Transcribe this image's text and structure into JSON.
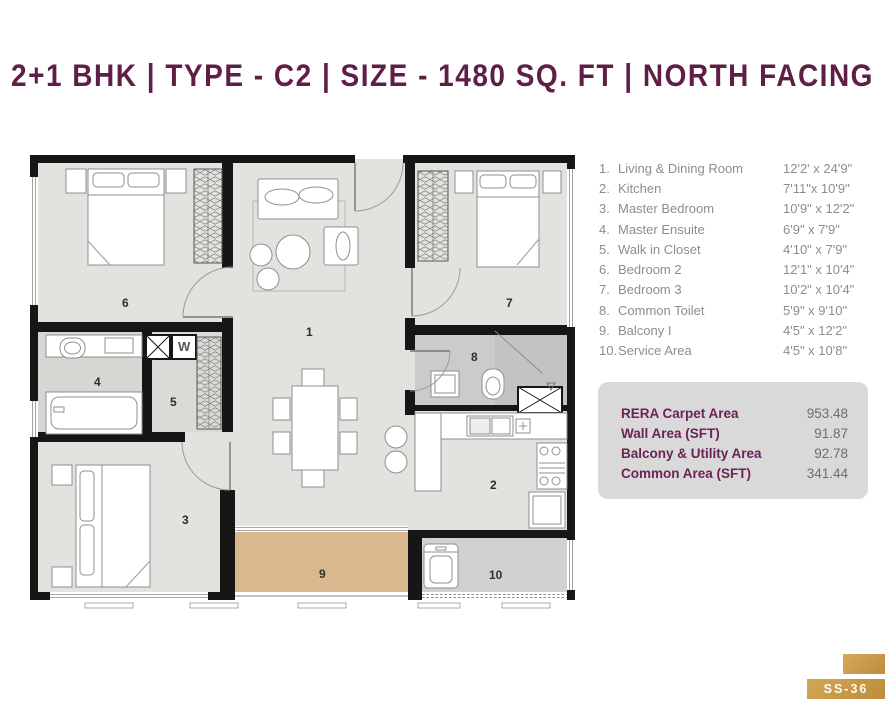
{
  "title": "2+1 BHK | TYPE - C2 | SIZE - 1480 SQ. FT | NORTH  FACING",
  "legend": {
    "items": [
      {
        "num": "1.",
        "label": "Living & Dining Room",
        "dim": "12'2' x 24'9\""
      },
      {
        "num": "2.",
        "label": "Kitchen",
        "dim": "7'11\"x 10'9\""
      },
      {
        "num": "3.",
        "label": "Master Bedroom",
        "dim": "10'9\" x 12'2\""
      },
      {
        "num": "4.",
        "label": "Master Ensuite",
        "dim": "6'9\" x 7'9\""
      },
      {
        "num": "5.",
        "label": "Walk in Closet",
        "dim": "4'10\" x 7'9\""
      },
      {
        "num": "6.",
        "label": "Bedroom 2",
        "dim": "12'1\" x 10'4\""
      },
      {
        "num": "7.",
        "label": "Bedroom 3",
        "dim": "10'2\" x 10'4\""
      },
      {
        "num": "8.",
        "label": "Common Toilet",
        "dim": "5'9\" x 9'10\""
      },
      {
        "num": "9.",
        "label": "Balcony I",
        "dim": "4'5\" x 12'2\""
      },
      {
        "num": "10.",
        "label": "Service Area",
        "dim": "4'5\" x 10'8\""
      }
    ]
  },
  "summary": {
    "rows": [
      {
        "label": "RERA Carpet Area",
        "value": "953.48"
      },
      {
        "label": "Wall Area (SFT)",
        "value": "91.87"
      },
      {
        "label": "Balcony & Utility Area",
        "value": "92.78"
      },
      {
        "label": "Common Area (SFT)",
        "value": "341.44"
      }
    ]
  },
  "plan": {
    "room_numbers": [
      "6",
      "1",
      "7",
      "4",
      "5",
      "8",
      "2",
      "3",
      "9",
      "10"
    ],
    "shaft_w_label": "W"
  },
  "badge": {
    "text": "SS-36"
  },
  "colors": {
    "accent": "#5e1e46",
    "gold": "#c99c4c",
    "floor": "#e3e2de",
    "toilet_floor": "#cbcbc9",
    "balcony_floor": "#d9b88d",
    "service_floor": "#cfd2cf",
    "wall": "#161616"
  }
}
